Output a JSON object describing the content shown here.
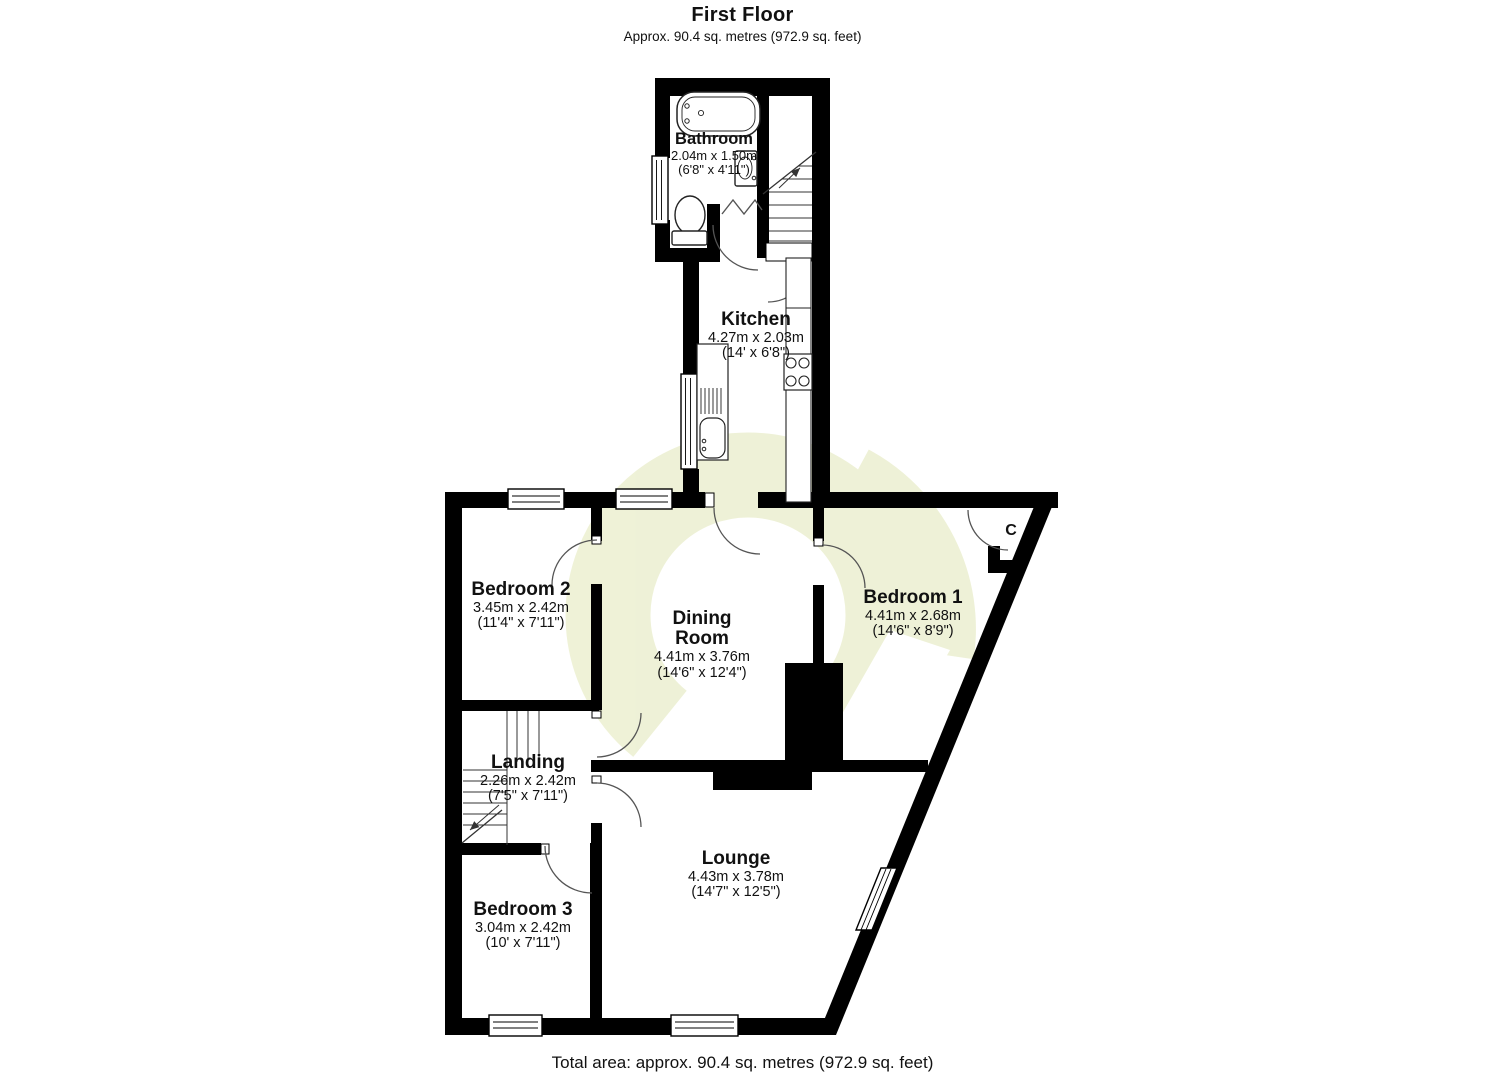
{
  "header": {
    "title": "First Floor",
    "subtitle": "Approx. 90.4 sq. metres (972.9 sq. feet)"
  },
  "footer": {
    "total_area": "Total area: approx. 90.4 sq. metres (972.9 sq. feet)"
  },
  "rooms": [
    {
      "id": "bathroom",
      "name": "Bathroom",
      "metric": "2.04m x 1.50m",
      "imperial": "(6'8\" x 4'11\")"
    },
    {
      "id": "kitchen",
      "name": "Kitchen",
      "metric": "4.27m x 2.03m",
      "imperial": "(14' x 6'8\")"
    },
    {
      "id": "bedroom-2",
      "name": "Bedroom 2",
      "metric": "3.45m x 2.42m",
      "imperial": "(11'4\" x 7'11\")"
    },
    {
      "id": "dining-room",
      "name": "Dining Room",
      "metric": "4.41m x 3.76m",
      "imperial": "(14'6\" x 12'4\")"
    },
    {
      "id": "bedroom-1",
      "name": "Bedroom 1",
      "metric": "4.41m x 2.68m",
      "imperial": "(14'6\" x 8'9\")"
    },
    {
      "id": "landing",
      "name": "Landing",
      "metric": "2.26m x 2.42m",
      "imperial": "(7'5\" x 7'11\")"
    },
    {
      "id": "lounge",
      "name": "Lounge",
      "metric": "4.43m x 3.78m",
      "imperial": "(14'7\" x 12'5\")"
    },
    {
      "id": "bedroom-3",
      "name": "Bedroom 3",
      "metric": "3.04m x 2.42m",
      "imperial": "(10' x 7'11\")"
    }
  ],
  "cupboard_label": "C",
  "colors": {
    "wall": "#000000",
    "floor": "#ffffff",
    "watermark": "#eef1d5",
    "text": "#111111"
  }
}
